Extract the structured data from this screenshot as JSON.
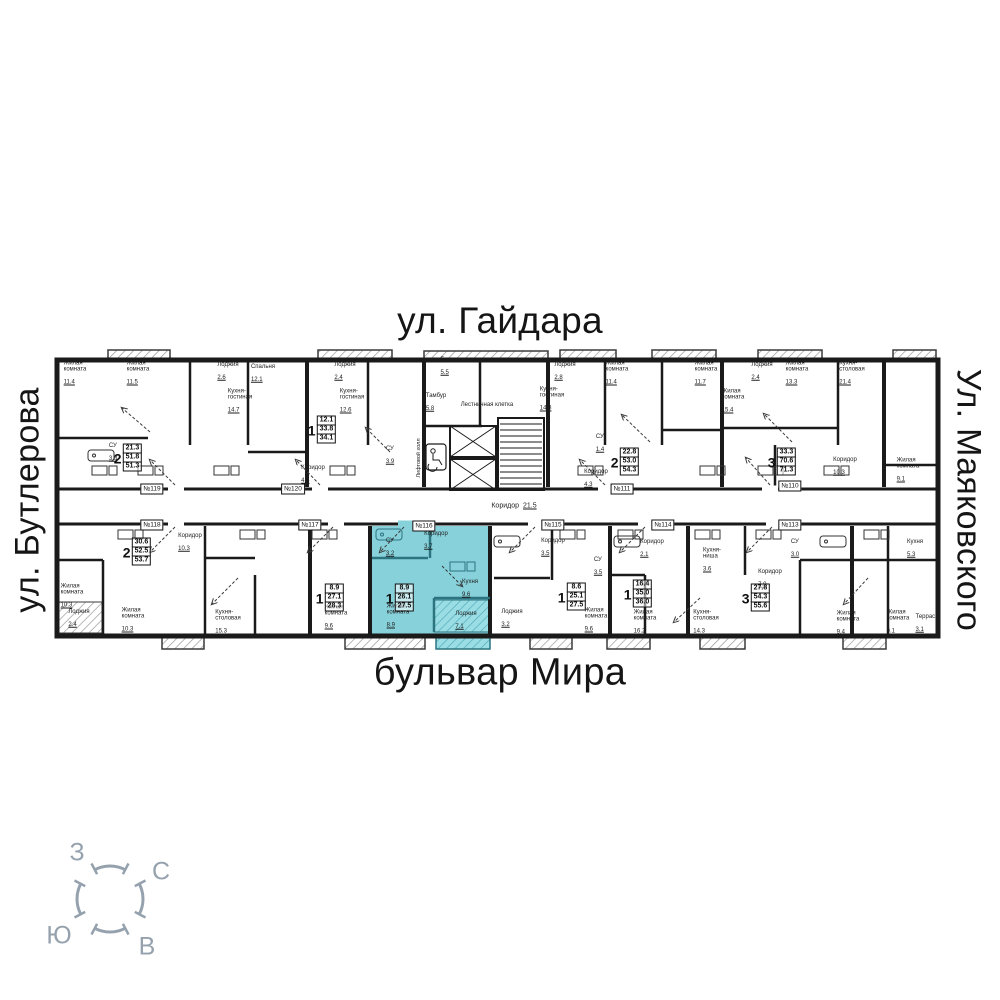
{
  "streets": {
    "top": "ул. Гайдара",
    "bottom": "бульвар Мира",
    "left": "ул. Бутлерова",
    "right": "Ул. Маяковского"
  },
  "compass": {
    "west": "З",
    "north": "С",
    "south": "Ю",
    "east": "В"
  },
  "highlight": {
    "unit": "№116",
    "color": "#87d1da"
  },
  "corridor": {
    "name": "Коридор",
    "area": "21.5"
  },
  "core": {
    "lift_hall": "Лифтовой холл"
  },
  "unit_tags": [
    {
      "x": 152,
      "y": 489,
      "label": "№119"
    },
    {
      "x": 293,
      "y": 489,
      "label": "№120"
    },
    {
      "x": 622,
      "y": 489,
      "label": "№111"
    },
    {
      "x": 790,
      "y": 486,
      "label": "№110"
    },
    {
      "x": 152,
      "y": 525,
      "label": "№118"
    },
    {
      "x": 310,
      "y": 525,
      "label": "№117"
    },
    {
      "x": 424,
      "y": 526,
      "label": "№116"
    },
    {
      "x": 553,
      "y": 525,
      "label": "№115"
    },
    {
      "x": 663,
      "y": 525,
      "label": "№114"
    },
    {
      "x": 790,
      "y": 525,
      "label": "№113"
    }
  ],
  "unit_labels": [
    {
      "x": 128,
      "y": 458,
      "t": "2",
      "a1": "21.3",
      "a2": "51.8",
      "a3": "51.3"
    },
    {
      "x": 322,
      "y": 430,
      "t": "1",
      "a1": "12.1",
      "a2": "33.8",
      "a3": "34.1"
    },
    {
      "x": 625,
      "y": 462,
      "t": "2",
      "a1": "22.8",
      "a2": "53.0",
      "a3": "54.3"
    },
    {
      "x": 782,
      "y": 462,
      "t": "3",
      "a1": "33.3",
      "a2": "70.6",
      "a3": "71.3"
    },
    {
      "x": 137,
      "y": 552,
      "t": "2",
      "a1": "30.6",
      "a2": "52.5",
      "a3": "53.7"
    },
    {
      "x": 330,
      "y": 598,
      "t": "1",
      "a1": "8.9",
      "a2": "27.1",
      "a3": "28.3"
    },
    {
      "x": 400,
      "y": 598,
      "t": "1",
      "a1": "8.9",
      "a2": "26.1",
      "a3": "27.5"
    },
    {
      "x": 572,
      "y": 597,
      "t": "1",
      "a1": "8.6",
      "a2": "25.1",
      "a3": "27.5"
    },
    {
      "x": 638,
      "y": 594,
      "t": "1",
      "a1": "16.4",
      "a2": "35.0",
      "a3": "36.0"
    },
    {
      "x": 756,
      "y": 598,
      "t": "3",
      "a1": "27.8",
      "a2": "54.3",
      "a3": "55.6"
    }
  ],
  "room_labels": [
    {
      "x": 75,
      "y": 373,
      "n": "Жилая\nкомната",
      "a": "11.4"
    },
    {
      "x": 138,
      "y": 373,
      "n": "Жилая\nкомната",
      "a": "11.5"
    },
    {
      "x": 228,
      "y": 371,
      "n": "Лоджия",
      "a": "2.6"
    },
    {
      "x": 240,
      "y": 401,
      "n": "Кухня-\nгостиная",
      "a": "14.7"
    },
    {
      "x": 263,
      "y": 373,
      "n": "Спальня",
      "a": "12.1"
    },
    {
      "x": 345,
      "y": 371,
      "n": "Лоджия",
      "a": "2.4"
    },
    {
      "x": 352,
      "y": 401,
      "n": "Кухня-\nгостиная",
      "a": "12.6"
    },
    {
      "x": 113,
      "y": 452,
      "n": "СУ",
      "a": "3.8"
    },
    {
      "x": 313,
      "y": 474,
      "n": "Коридор",
      "a": "4.4"
    },
    {
      "x": 390,
      "y": 455,
      "n": "СУ",
      "a": "3.9"
    },
    {
      "x": 452,
      "y": 366,
      "n": "Галерея",
      "a": "5.5"
    },
    {
      "x": 436,
      "y": 402,
      "n": "Тамбур",
      "a": "5.8"
    },
    {
      "x": 487,
      "y": 408,
      "n": "Лестничная клетка"
    },
    {
      "x": 565,
      "y": 371,
      "n": "Лоджия",
      "a": "2.8"
    },
    {
      "x": 552,
      "y": 399,
      "n": "Кухня-\nгостиная",
      "a": "14.8"
    },
    {
      "x": 617,
      "y": 373,
      "n": "Жилая\nкомната",
      "a": "11.4"
    },
    {
      "x": 706,
      "y": 373,
      "n": "Жилая\nкомната",
      "a": "11.7"
    },
    {
      "x": 762,
      "y": 371,
      "n": "Лоджия",
      "a": "2.4"
    },
    {
      "x": 797,
      "y": 373,
      "n": "Жилая\nкомната",
      "a": "13.3"
    },
    {
      "x": 733,
      "y": 401,
      "n": "Жилая\nкомната",
      "a": "15.4"
    },
    {
      "x": 852,
      "y": 373,
      "n": "Кухня-\nстоловая",
      "a": "21.4"
    },
    {
      "x": 600,
      "y": 443,
      "n": "СУ",
      "a": "1.4"
    },
    {
      "x": 596,
      "y": 478,
      "n": "Коридор",
      "a": "4.3"
    },
    {
      "x": 845,
      "y": 466,
      "n": "Коридор",
      "a": "10.3"
    },
    {
      "x": 908,
      "y": 470,
      "n": "Жилая\nкомната",
      "a": "9.1"
    },
    {
      "x": 72,
      "y": 596,
      "n": "Жилая\nкомната",
      "a": "10.3"
    },
    {
      "x": 79,
      "y": 618,
      "n": "Лоджия",
      "a": "2.4"
    },
    {
      "x": 133,
      "y": 620,
      "n": "Жилая\nкомната",
      "a": "10.3"
    },
    {
      "x": 190,
      "y": 542,
      "n": "Коридор",
      "a": "10.3"
    },
    {
      "x": 228,
      "y": 622,
      "n": "Кухня-\nстоловая",
      "a": "15.3"
    },
    {
      "x": 336,
      "y": 617,
      "n": "Жилая\nкомната",
      "a": "9.6"
    },
    {
      "x": 398,
      "y": 616,
      "n": "Жилая\nкомната",
      "a": "8.9"
    },
    {
      "x": 436,
      "y": 540,
      "n": "Коридор",
      "a": "3.7"
    },
    {
      "x": 390,
      "y": 547,
      "n": "СУ",
      "a": "3.2"
    },
    {
      "x": 470,
      "y": 588,
      "n": "Кухня",
      "a": "9.6"
    },
    {
      "x": 466,
      "y": 620,
      "n": "Лоджия",
      "a": "7.1"
    },
    {
      "x": 512,
      "y": 618,
      "n": "Лоджия",
      "a": "3.2"
    },
    {
      "x": 553,
      "y": 547,
      "n": "Коридор",
      "a": "3.5"
    },
    {
      "x": 598,
      "y": 566,
      "n": "СУ",
      "a": "3.5"
    },
    {
      "x": 596,
      "y": 620,
      "n": "Жилая\nкомната",
      "a": "9.6"
    },
    {
      "x": 645,
      "y": 622,
      "n": "Жилая\nкомната",
      "a": "16.2"
    },
    {
      "x": 712,
      "y": 560,
      "n": "Кухня-\nниша",
      "a": "3.6"
    },
    {
      "x": 706,
      "y": 622,
      "n": "Кухня-\nстоловая",
      "a": "14.3"
    },
    {
      "x": 770,
      "y": 578,
      "n": "Коридор",
      "a": "7.0"
    },
    {
      "x": 795,
      "y": 548,
      "n": "СУ",
      "a": "3.0"
    },
    {
      "x": 848,
      "y": 623,
      "n": "Жилая\nкомната",
      "a": "9.4"
    },
    {
      "x": 898,
      "y": 622,
      "n": "Жилая\nкомната",
      "a": "9.1"
    },
    {
      "x": 927,
      "y": 623,
      "n": "Терраса",
      "a": "3.1"
    },
    {
      "x": 915,
      "y": 548,
      "n": "Кухня",
      "a": "5.3"
    },
    {
      "x": 652,
      "y": 548,
      "n": "Коридор",
      "a": "2.1"
    }
  ]
}
